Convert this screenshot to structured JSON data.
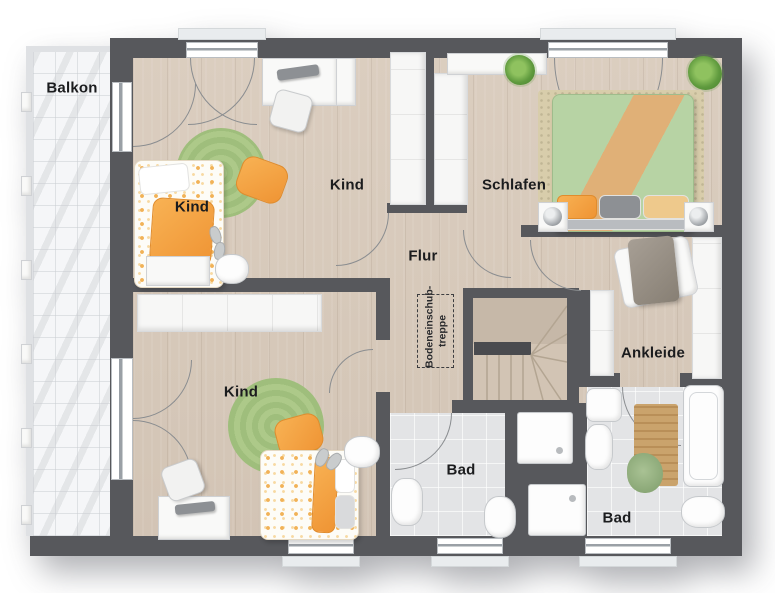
{
  "plan": {
    "type": "floor-plan",
    "floor": "upper-floor"
  },
  "rooms": {
    "balkon": {
      "label": "Balkon"
    },
    "kind_a": {
      "label": "Kind"
    },
    "kind_b": {
      "label": "Kind"
    },
    "kind_c": {
      "label": "Kind"
    },
    "schlafen": {
      "label": "Schlafen"
    },
    "flur": {
      "label": "Flur"
    },
    "ankleide": {
      "label": "Ankleide"
    },
    "bad_a": {
      "label": "Bad"
    },
    "bad_b": {
      "label": "Bad"
    }
  },
  "annotations": {
    "attic_stairs": {
      "line1": "Bodeneinschub-",
      "line2": "treppe"
    }
  },
  "colors": {
    "wall": "#57585c",
    "wood_floor": "#d9cbbc",
    "bath_tile": "#e3e4e6",
    "balcony_floor": "#f5f6f8",
    "accent_orange": "#ef9434",
    "rug_green": "#a7c584",
    "bed_green": "#b7d3a4",
    "bed_tan": "#e0b077"
  }
}
